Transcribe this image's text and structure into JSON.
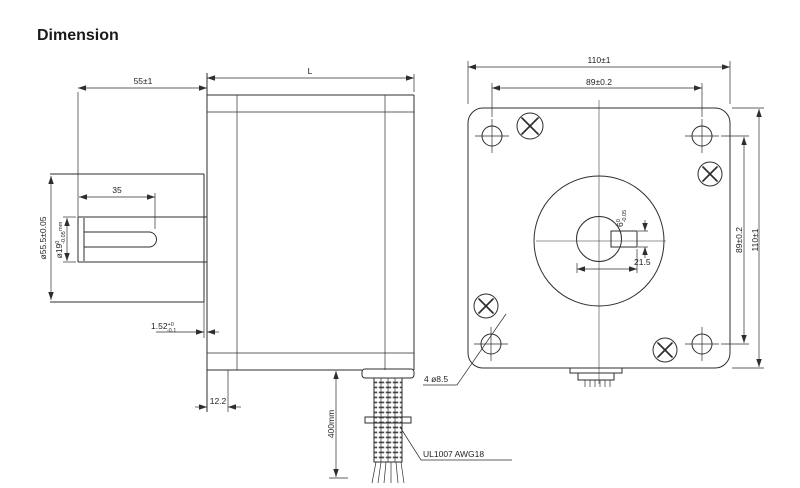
{
  "title": "Dimension",
  "colors": {
    "line": "#2e2e2e",
    "text": "#1f1f1f",
    "background": "#ffffff"
  },
  "side_view": {
    "shaft_length": "55±1",
    "keyway_length": "35",
    "pilot_diameter": "ø55.5±0.05",
    "shaft_diameter": {
      "nominal": "ø19",
      "tol_upper": "0",
      "tol_lower": "-0.05",
      "unit": "mm"
    },
    "pilot_height": {
      "nominal": "1.52",
      "tol_upper": "+0",
      "tol_lower": "-0.1"
    },
    "flange_step": "12.2"
  },
  "body_view": {
    "length_label": "L",
    "cable_length": "400mm",
    "cable_spec": "UL1007 AWG18",
    "mounting_holes": "4 ø8.5"
  },
  "front_view": {
    "outer_width": "110±1",
    "hole_spacing_top": "89±0.2",
    "hole_spacing_right": "89±0.2",
    "outer_height": "110±1",
    "keyway_width": {
      "nominal": "6",
      "tol_upper": "0",
      "tol_lower": "-0.05"
    },
    "keyway_offset": "21.5"
  }
}
